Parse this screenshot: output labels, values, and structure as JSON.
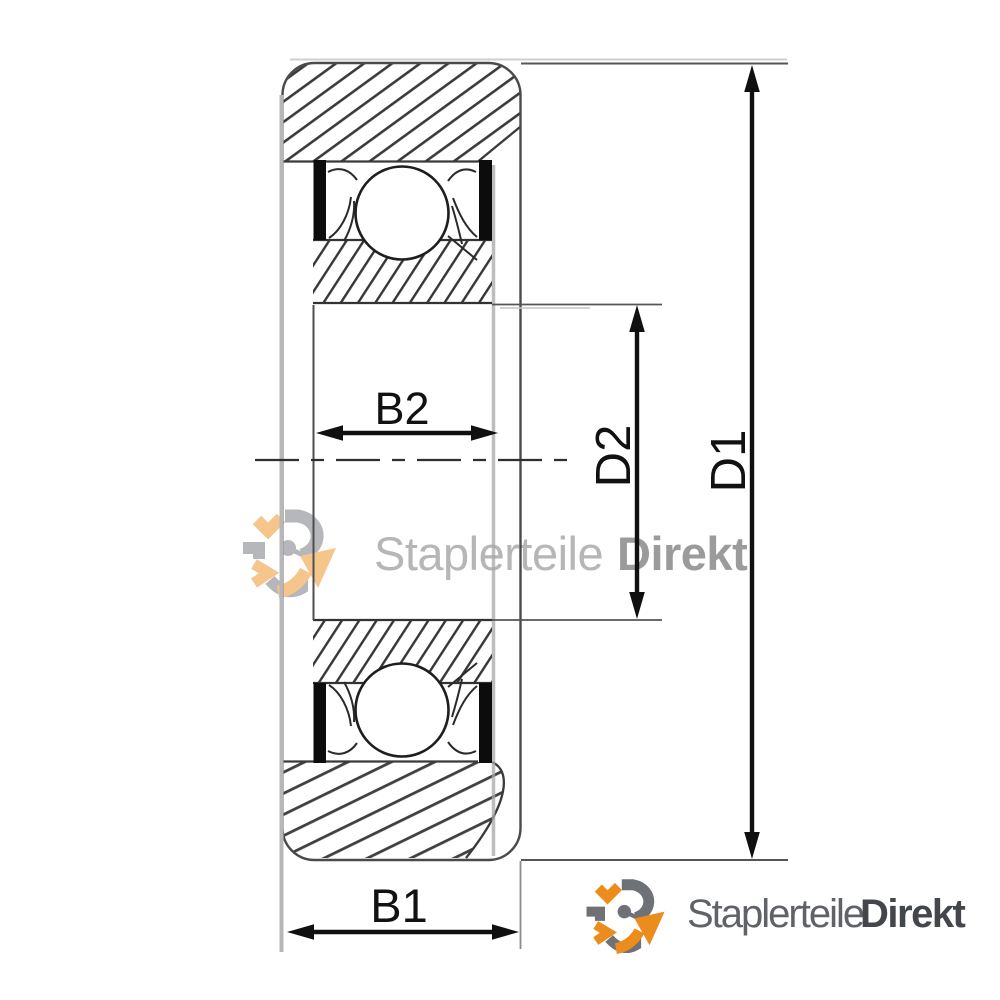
{
  "drawing": {
    "dimension_labels": {
      "b1": "B1",
      "b2": "B2",
      "d1": "D1",
      "d2": "D2"
    }
  },
  "watermark": {
    "brand_regular": "Staplerteile",
    "brand_bold": "Direkt"
  },
  "footer_logo": {
    "brand_regular": "Staplerteile",
    "brand_bold": "Direkt"
  },
  "colors": {
    "accent_orange": "#EC8C1C",
    "logo_gray": "#6E7277",
    "watermark_text_light": "#B6B6B6",
    "watermark_text_bold": "#9B9B9B",
    "footer_text_regular": "#5F6368",
    "footer_text_bold": "#43474C",
    "dimension_black": "#111111"
  }
}
